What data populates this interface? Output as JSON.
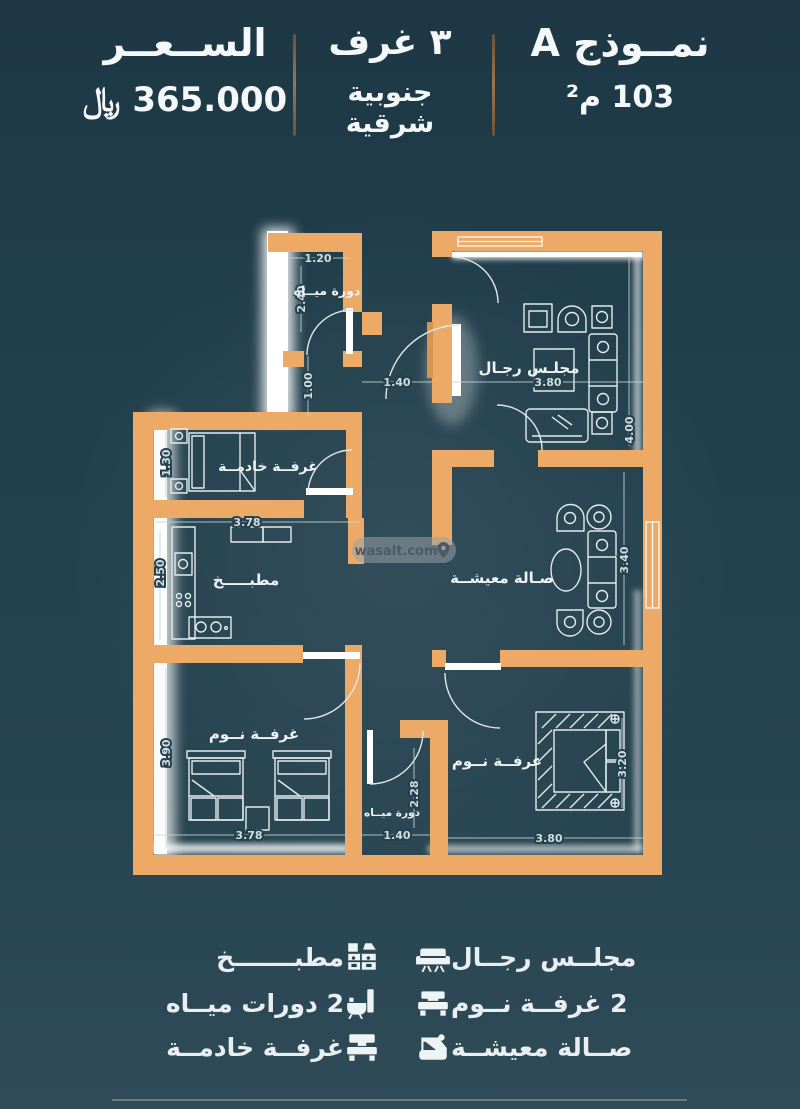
{
  "header": {
    "model": "نمــوذج A",
    "area": "103 م²",
    "rooms": "٣ غرف",
    "orientation": "جنوبية شرقية",
    "price_label": "الســعــر",
    "price_value": "365.000 ﷼"
  },
  "plan": {
    "watermark": "wasalt.com",
    "rooms": {
      "bath_top": "دورة ميــاه",
      "majlis": "مجلـس رجـال",
      "maid": "غرفــة خادمــة",
      "kitchen": "مطبـــــخ",
      "living": "صـالة معيشــة",
      "bedroom_left": "غرفــة نــوم",
      "bedroom_right": "غرفــة نــوم",
      "bath_bottom": "دورة ميــاه"
    },
    "dims": {
      "bath_w": "1.20",
      "bath_h": "2.40",
      "hall_h": "1.00",
      "hall_w": "1.40",
      "majlis_w": "3.80",
      "majlis_h": "4.00",
      "maid_h": "1.30",
      "kitchen_w": "3.78",
      "kitchen_h": "2.50",
      "living_h": "3.40",
      "bed1_h": "3.90",
      "bed1_w": "3.78",
      "wc_h": "2.28",
      "wc_w": "1.40",
      "bed2_w": "3.80",
      "bed2_h": "3.20"
    }
  },
  "legend": {
    "right": [
      {
        "label": "مجلــس رجــال",
        "icon": "sofa-icon"
      },
      {
        "label": "2 غرفــة نــوم",
        "icon": "single-bed-icon"
      },
      {
        "label": "صــالة معيشــة",
        "icon": "armchair-icon"
      }
    ],
    "left": [
      {
        "label": "مطبـــــــخ",
        "icon": "kitchen-icon"
      },
      {
        "label": "2 دورات ميــاه",
        "icon": "bath-icon"
      },
      {
        "label": "غرفــة خادمــة",
        "icon": "maid-bed-icon"
      }
    ]
  }
}
